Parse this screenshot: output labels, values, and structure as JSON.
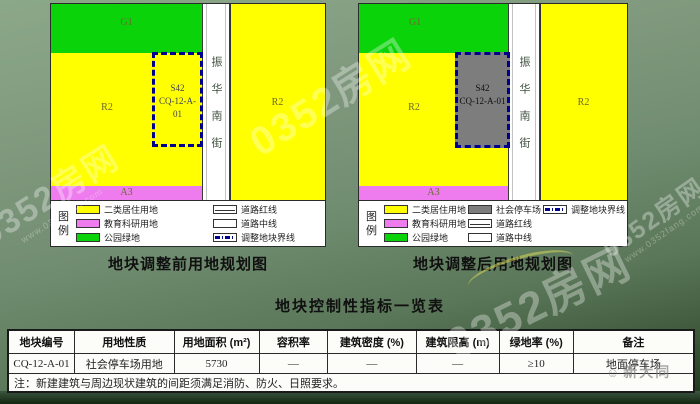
{
  "maps": {
    "before": {
      "caption": "地块调整前用地规划图",
      "labels": {
        "park": "G1",
        "residential_left": "R2",
        "residential_right": "R2",
        "education": "A3",
        "plot_type": "S42",
        "plot_code": "CQ-12-A-01"
      },
      "street": "振华南街"
    },
    "after": {
      "caption": "地块调整后用地规划图",
      "labels": {
        "park": "G1",
        "residential_left": "R2",
        "residential_right": "R2",
        "education": "A3",
        "plot_type": "S42",
        "plot_code": "CQ-12-A-01"
      },
      "street": "振华南街"
    }
  },
  "legend": {
    "title": "图例",
    "residential": "二类居住用地",
    "education": "教育科研用地",
    "park": "公园绿地",
    "parking": "社会停车场",
    "road_red": "道路红线",
    "road_center": "道路中线",
    "boundary": "调整地块界线"
  },
  "colors": {
    "residential": "#ffff00",
    "education": "#ee7cee",
    "park": "#0ad30a",
    "parking": "#7d7d7d",
    "boundary": "#00008f"
  },
  "table": {
    "title": "地块控制性指标一览表",
    "headers": [
      "地块编号",
      "用地性质",
      "用地面积 (m²)",
      "容积率",
      "建筑密度 (%)",
      "建筑限高 (m)",
      "绿地率 (%)",
      "备注"
    ],
    "row": [
      "CQ-12-A-01",
      "社会停车场用地",
      "5730",
      "—",
      "—",
      "—",
      "≥10",
      "地面停车场"
    ],
    "note": "注：新建建筑与周边现状建筑的间距须满足消防、防火、日照要求。"
  },
  "watermarks": {
    "brand": "0352房网",
    "url": "www.0352fang.com",
    "corner": "新大同",
    "corner_face": "☺"
  }
}
